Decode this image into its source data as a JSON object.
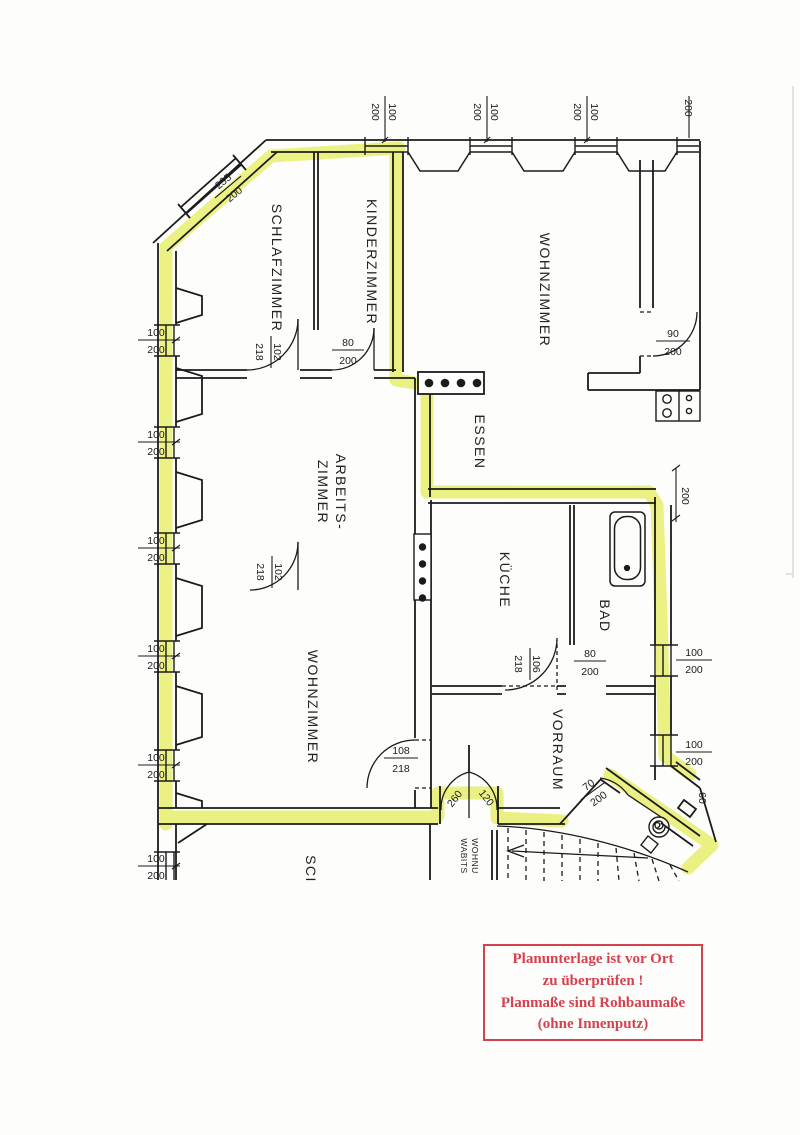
{
  "plan": {
    "highlight_color": "#e9ee6d",
    "room_labels": {
      "schlafzimmer": "SCHLAFZIMMER",
      "kinderzimmer": "KINDERZIMMER",
      "wohnzimmer_top": "WOHNZIMMER",
      "essen": "ESSEN",
      "arbeitszimmer_line1": "ARBEITS-",
      "arbeitszimmer_line2": "ZIMMER",
      "kueche": "KÜCHE",
      "bad": "BAD",
      "wohnzimmer_bottom": "WOHNZIMMER",
      "vorraum": "VORRAUM",
      "sci_partial": "SCI",
      "wohnu_line1": "WOHNU",
      "wohnu_line2": "WABITS"
    },
    "dimensions": {
      "d100": "100",
      "d200": "200",
      "d235": "235",
      "d102": "102",
      "d218": "218",
      "d80": "80",
      "d90": "90",
      "d106": "106",
      "d108": "108",
      "d70": "70",
      "d60": "60",
      "d260": "260",
      "d120": "120"
    }
  },
  "stamp": {
    "line1": "Planunterlage ist vor Ort",
    "line2": "zu überprüfen !",
    "line3": "Planmaße sind Rohbaumaße",
    "line4": "(ohne Innenputz)",
    "color": "#d5414e"
  }
}
